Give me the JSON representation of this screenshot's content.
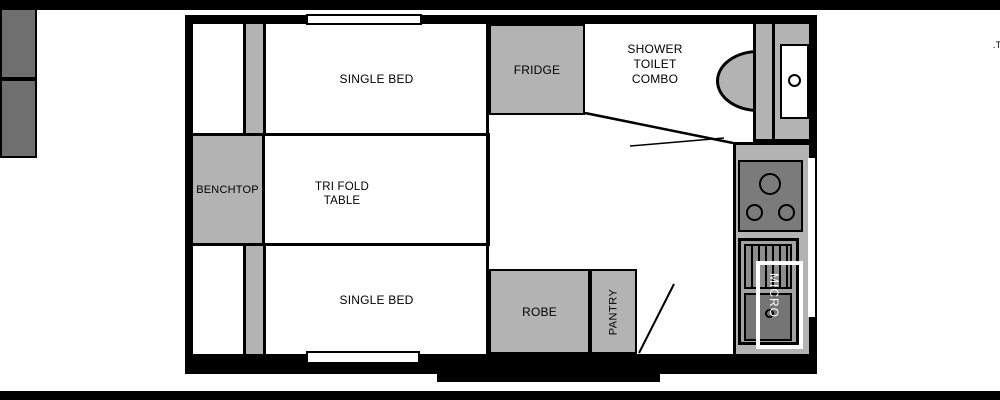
{
  "diagram": {
    "type": "caravan-floorplan",
    "colors": {
      "wall": "#000000",
      "furniture_gray": "#b3b3b3",
      "appliance_dark": "#6f6f6f",
      "cooktop_gray": "#7b7b7b",
      "sink_unit_gray": "#a3a3a3",
      "drainer_gray": "#8d8d8d",
      "floor_white": "#ffffff",
      "micro_outline": "#ffffff"
    },
    "labels": {
      "tv": ".T.",
      "bed_front": "SINGLE BED",
      "bed_rear": "SINGLE BED",
      "fridge": "FRIDGE",
      "bathroom_lines": [
        "SHOWER",
        "TOILET",
        "COMBO"
      ],
      "benchtop": "BENCHTOP",
      "table_lines": [
        "TRI FOLD",
        "TABLE"
      ],
      "robe": "ROBE",
      "pantry": "PANTRY",
      "micro": "MICRO"
    }
  }
}
